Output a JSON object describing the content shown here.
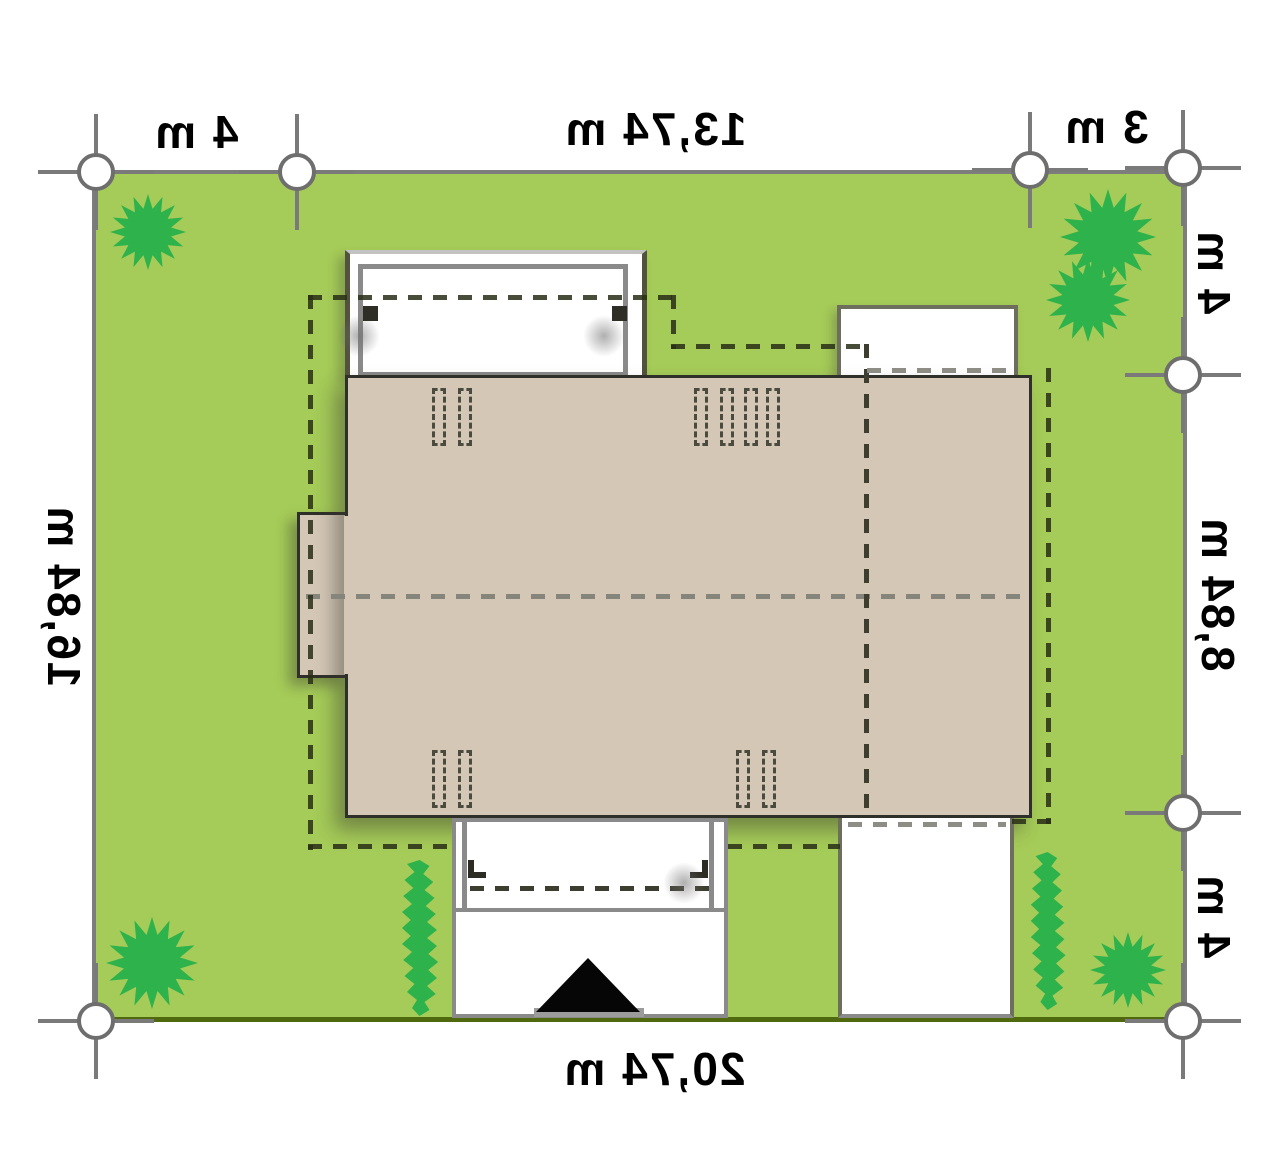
{
  "page": {
    "title": "Building plot site plan",
    "units": "m"
  },
  "colors": {
    "lawn": "#a5cb58",
    "lawn_border": "#7d7d7d",
    "street_border": "#50690f",
    "tree": "#2db24c",
    "roof": "#d4c7b6",
    "roof_outline": "#30302a",
    "hardscape": "#ffffff",
    "hardscape_border": "#8a8a8a",
    "setback_dash": "#2c2e16",
    "ridge_dash": "#85857b",
    "marker_gray": "#6e6e6e",
    "arrow": "#060606",
    "text": "#000000"
  },
  "dimensions": {
    "top_left": {
      "label": "4 m"
    },
    "top_center": {
      "label": "13,74 m"
    },
    "top_right": {
      "label": "3 m"
    },
    "right_top": {
      "label": "4 m"
    },
    "right_center": {
      "label": "8,84 m"
    },
    "right_bottom": {
      "label": "4 m"
    },
    "left_center": {
      "label": "16,84 m"
    },
    "bottom_center": {
      "label": "20,74 m"
    }
  },
  "features": {
    "plot": "lawn parcel with boundary survey markers",
    "house": "house roof footprint with left bay, ridge line, roof windows",
    "terraces": [
      "top terrace",
      "right terrace"
    ],
    "porch": "entrance porch",
    "driveways": [
      "main entrance driveway with arrow",
      "garage driveway"
    ],
    "trees": 5,
    "hedges": 2,
    "survey_markers": 8
  }
}
